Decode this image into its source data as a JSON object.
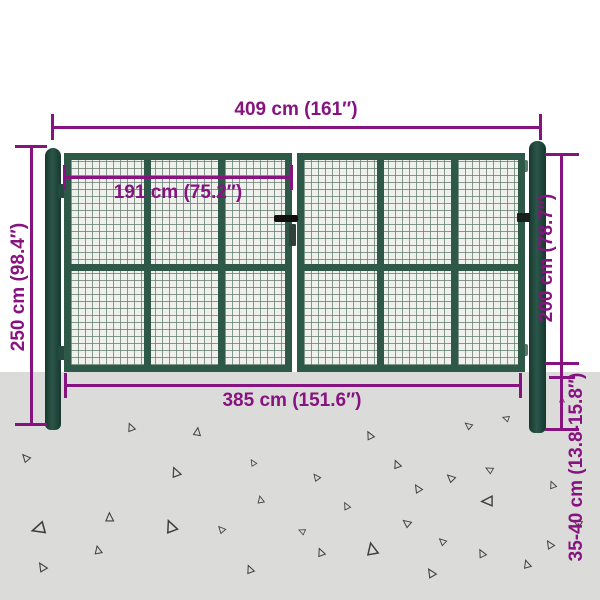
{
  "product": {
    "type_hint": "mesh-garden-gate-dimension-diagram"
  },
  "dimensions": {
    "top": {
      "label": "409 cm (161″)"
    },
    "inner_width": {
      "label": "191 cm (75.2″)"
    },
    "left_height": {
      "label": "250 cm (98.4″)"
    },
    "gate_height": {
      "label": "200 cm (78.7″)"
    },
    "ground_depth": {
      "label": "35-40 cm (13.8-15.8″)"
    },
    "bottom_width": {
      "label": "385 cm (151.6″)"
    }
  },
  "colors": {
    "dimension_line": "#871381",
    "gate_frame": "#2e5847",
    "gate_post": "#20473c",
    "mesh_background": "#f0f1ed",
    "ground": "#dbdbd9",
    "triangle_outline": "#3f3f3f"
  },
  "ground": {
    "triangles": [
      [
        132,
        428,
        10,
        100
      ],
      [
        198,
        433,
        10,
        130
      ],
      [
        27,
        458,
        10,
        80
      ],
      [
        254,
        463,
        8,
        90
      ],
      [
        177,
        473,
        12,
        100
      ],
      [
        261,
        500,
        9,
        110
      ],
      [
        40,
        527,
        16,
        15
      ],
      [
        110,
        518,
        11,
        120
      ],
      [
        172,
        527,
        15,
        100
      ],
      [
        222,
        529,
        9,
        80
      ],
      [
        99,
        551,
        10,
        110
      ],
      [
        43,
        567,
        11,
        90
      ],
      [
        251,
        570,
        10,
        100
      ],
      [
        371,
        436,
        10,
        95
      ],
      [
        469,
        425,
        9,
        70
      ],
      [
        507,
        418,
        8,
        50
      ],
      [
        398,
        465,
        10,
        100
      ],
      [
        317,
        477,
        9,
        85
      ],
      [
        452,
        478,
        10,
        75
      ],
      [
        490,
        469,
        9,
        60
      ],
      [
        419,
        489,
        10,
        90
      ],
      [
        347,
        506,
        9,
        95
      ],
      [
        489,
        500,
        14,
        30
      ],
      [
        408,
        523,
        10,
        70
      ],
      [
        303,
        531,
        8,
        55
      ],
      [
        322,
        553,
        10,
        100
      ],
      [
        373,
        550,
        15,
        110
      ],
      [
        443,
        541,
        9,
        75
      ],
      [
        483,
        554,
        10,
        95
      ],
      [
        528,
        565,
        10,
        105
      ],
      [
        432,
        573,
        11,
        90
      ],
      [
        562,
        400,
        7,
        120
      ],
      [
        553,
        485,
        9,
        100
      ],
      [
        579,
        523,
        10,
        60
      ],
      [
        551,
        545,
        10,
        90
      ]
    ]
  }
}
